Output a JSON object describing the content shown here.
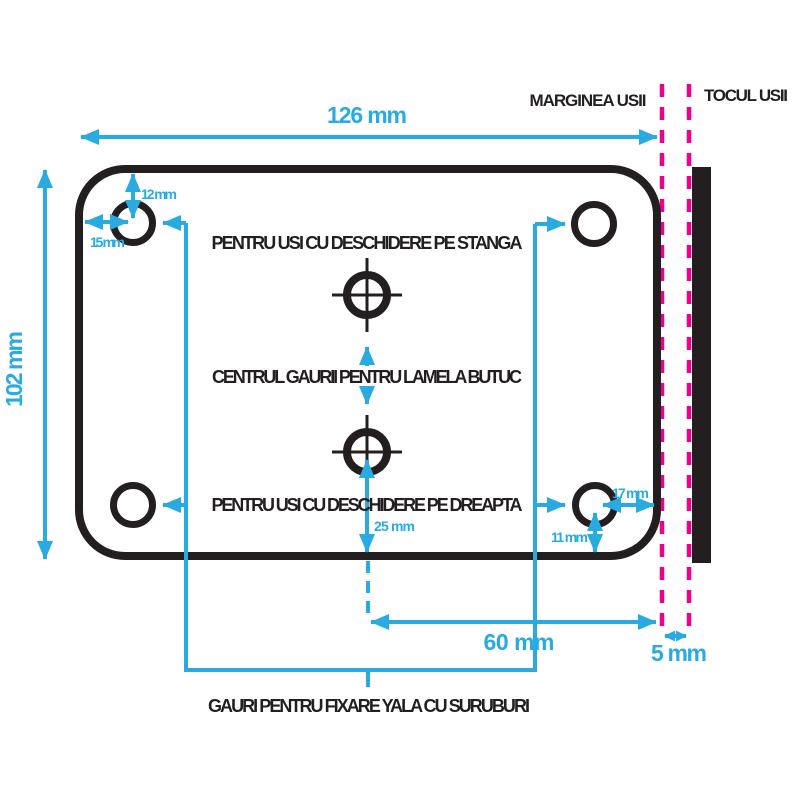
{
  "dims": {
    "plate_width": "126 mm",
    "plate_height": "102 mm",
    "hole_top_offset": "12 mm",
    "hole_left_offset": "15 mm",
    "hole_right_offset": "17 mm",
    "hole_bottom_offset": "11 mm",
    "cylinder_bottom_offset": "25 mm",
    "cylinder_to_edge": "60 mm",
    "edge_to_frame": "5 mm"
  },
  "labels": {
    "left_opening": "PENTRU USI CU DESCHIDERE PE STANGA",
    "cylinder_center": "CENTRUL GAURII PENTRU LAMELA BUTUC",
    "right_opening": "PENTRU USI CU DESCHIDERE PE DREAPTA",
    "screw_holes": "GAURI PENTRU FIXARE YALA CU SURUBURI",
    "door_edge": "MARGINEA USII",
    "door_frame": "TOCUL USII"
  },
  "colors": {
    "dimension_accent": "#29ABE2",
    "reference_accent": "#EC008C",
    "drawing_ink": "#231F20"
  }
}
